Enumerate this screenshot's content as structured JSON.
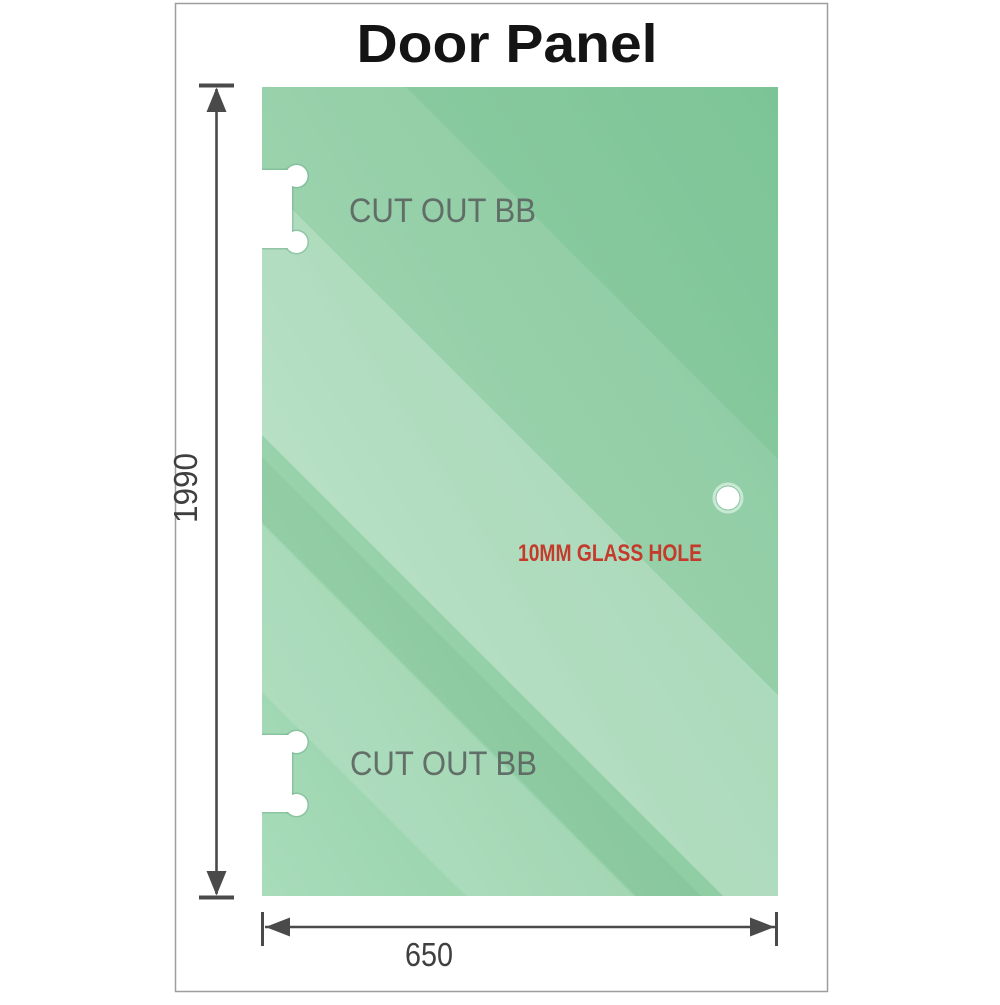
{
  "title": "Door Panel",
  "panel": {
    "cutout_top_label": "CUT OUT BB",
    "cutout_bottom_label": "CUT OUT BB",
    "hole_label": "10MM GLASS HOLE"
  },
  "dimensions": {
    "height": "1990",
    "width": "650"
  },
  "colors": {
    "title": "#141414",
    "cutout_label": "#5d6662",
    "hole_label": "#c43b2c",
    "dimension_text": "#3f3f3f",
    "dimension_line": "#4a4a4a",
    "frame_border": "#9e9e9e",
    "glass_light": "#a8dcba",
    "glass_mid": "#8fcda3",
    "glass_dark": "#7cc496",
    "cutout_outline": "#6fae8b"
  }
}
